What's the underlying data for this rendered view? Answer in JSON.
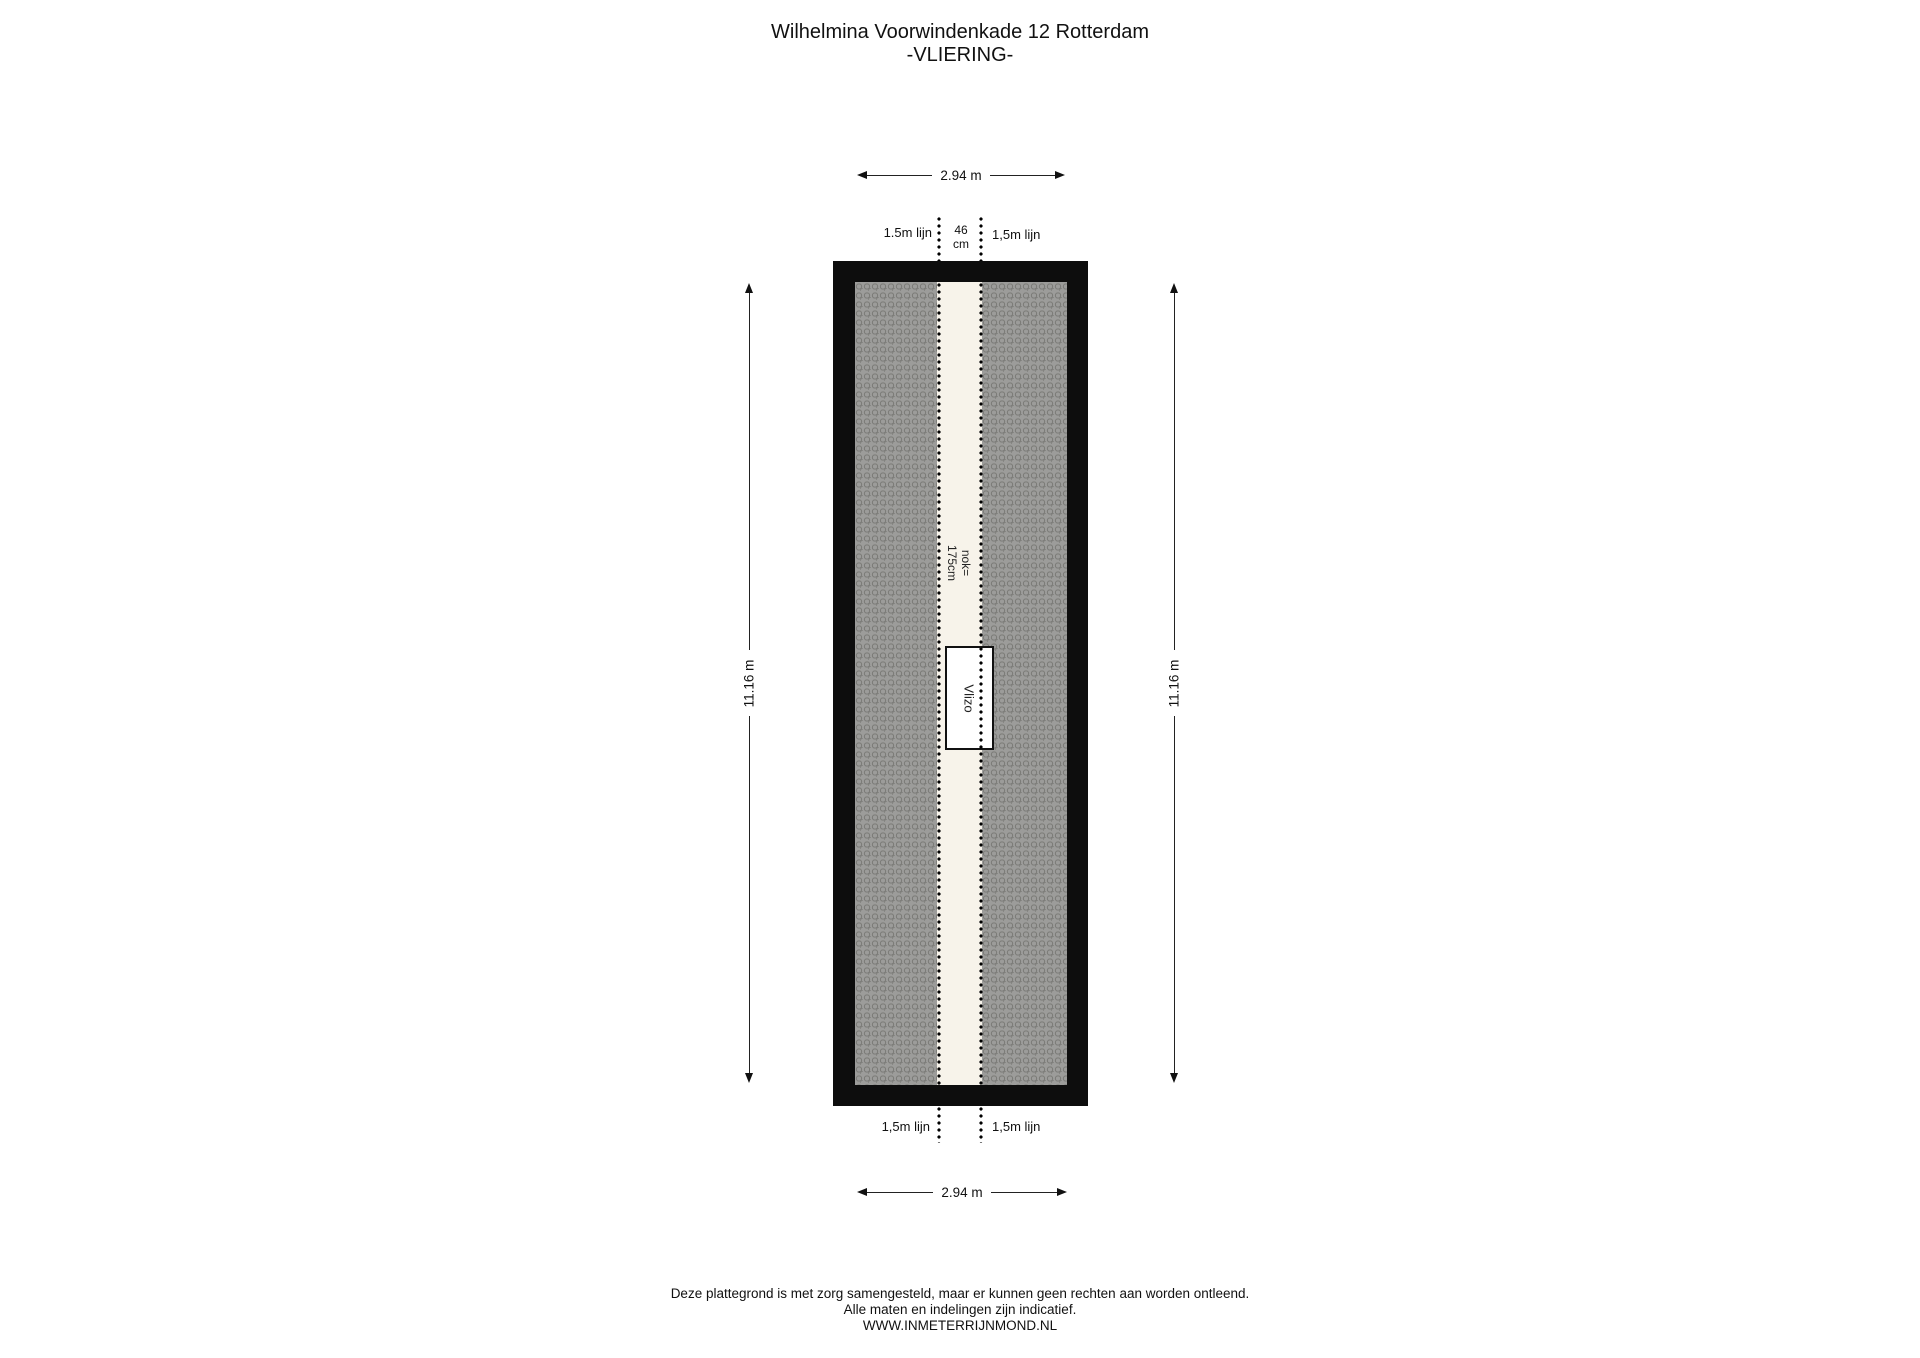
{
  "title": {
    "line1": "Wilhelmina Voorwindenkade 12 Rotterdam",
    "line2": "-VLIERING-"
  },
  "dimensions": {
    "top_width": "2.94 m",
    "bottom_width": "2.94 m",
    "left_height": "11.16 m",
    "right_height": "11.16 m"
  },
  "labels": {
    "top_left_line": "1.5m lijn",
    "top_right_line": "1,5m lijn",
    "bottom_left_line": "1,5m lijn",
    "bottom_right_line": "1,5m lijn",
    "gap_width_line1": "46",
    "gap_width_line2": "cm",
    "ridge_line1": "nok=",
    "ridge_line2": "175cm",
    "hatch_box": "Vlizo"
  },
  "footer": {
    "line1": "Deze plattegrond is met zorg samengesteld, maar er kunnen geen rechten aan worden ontleend.",
    "line2": "Alle maten en indelingen zijn indicatief.",
    "line3": "WWW.INMETERRIJNMOND.NL"
  },
  "colors": {
    "wall": "#0d0d0d",
    "roof_hatch": "#9c9c9a",
    "ridge_strip": "#f7f3ea",
    "text": "#111111"
  }
}
